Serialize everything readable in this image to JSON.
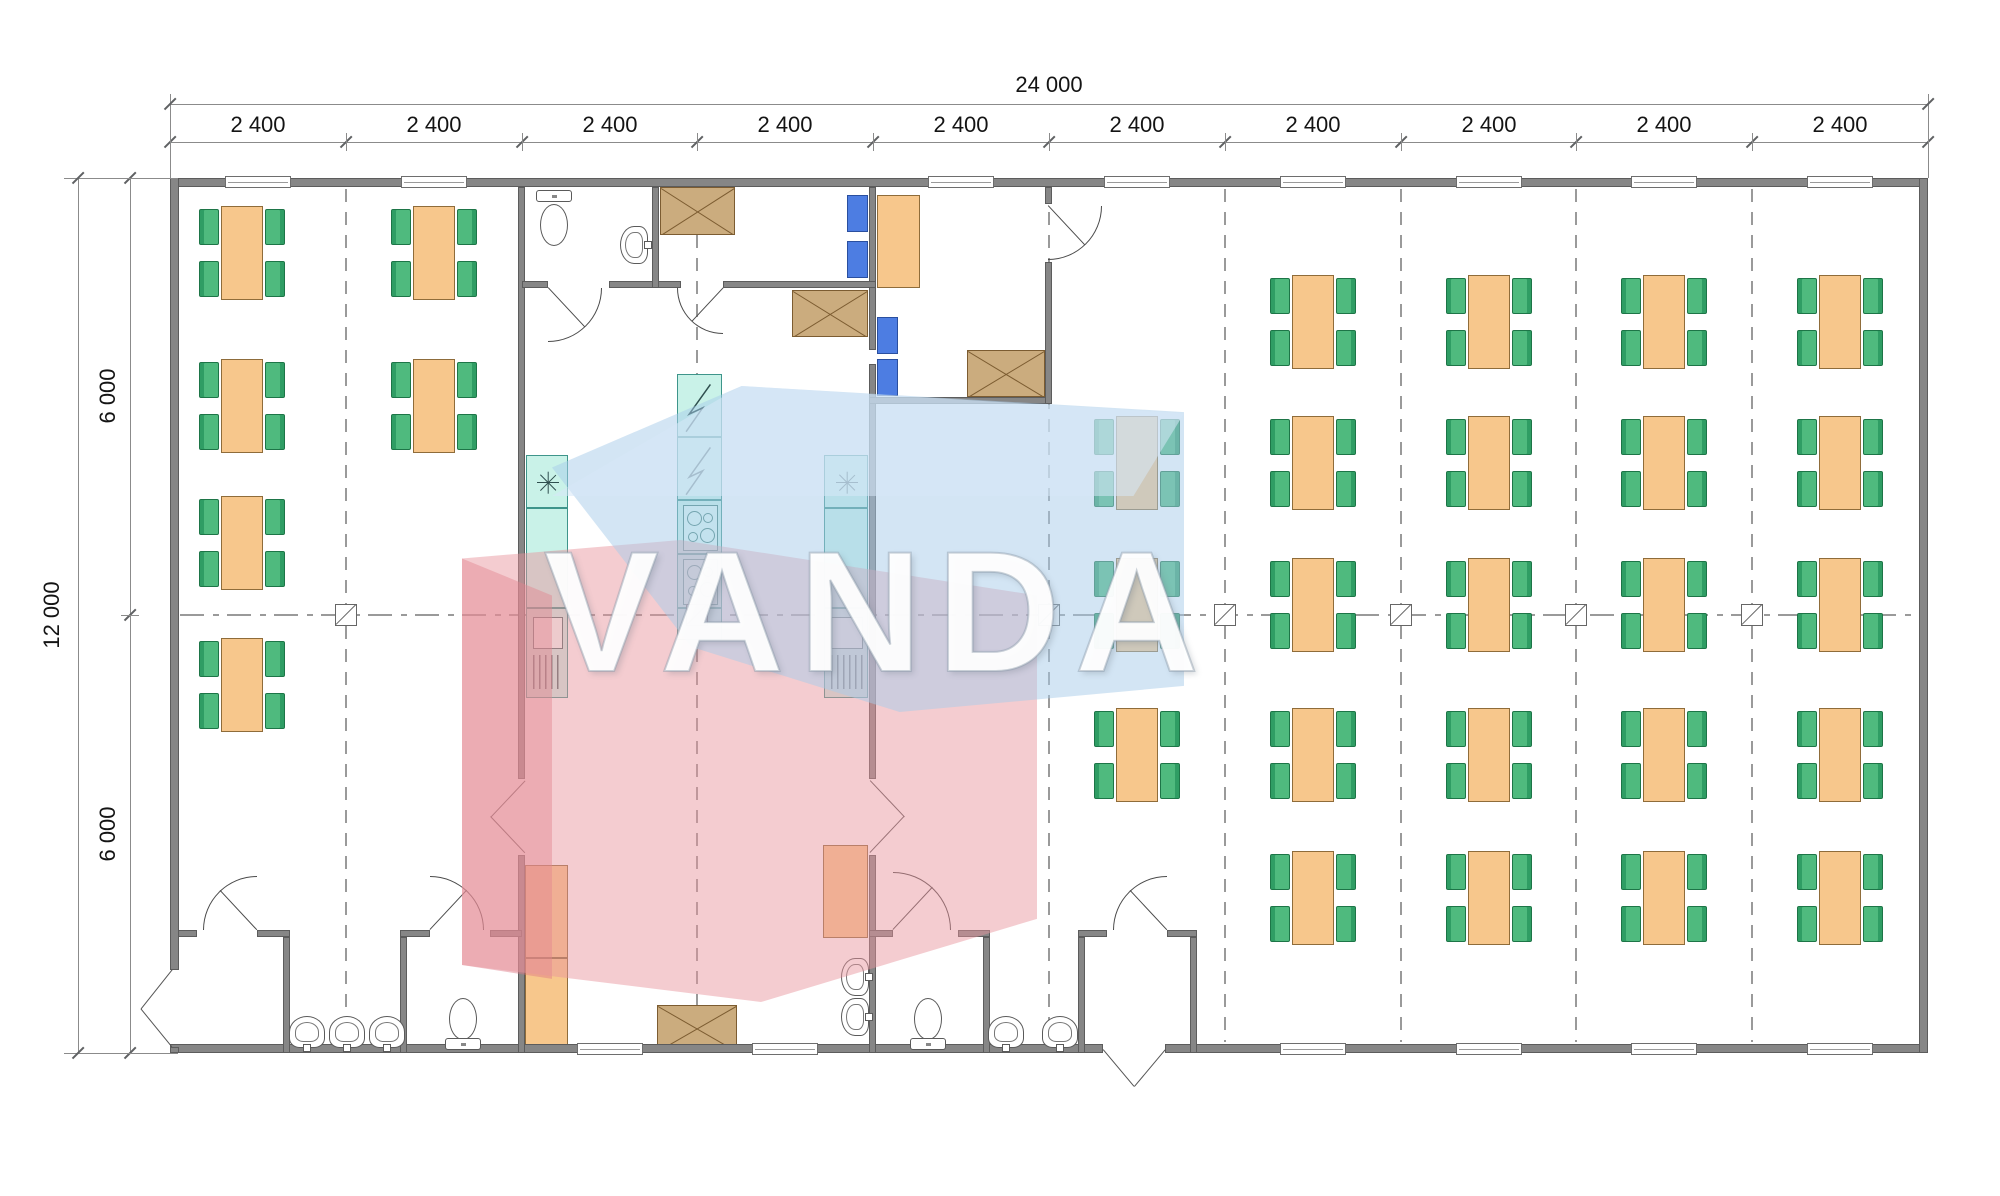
{
  "watermark": {
    "text": "VANDA",
    "blue": "rgba(168,203,233,0.5)",
    "blue_light": "rgba(215,232,248,0.55)",
    "red": "rgba(232,148,156,0.48)",
    "red_dark": "rgba(222,120,132,0.45)"
  },
  "dimensions": {
    "top_total": "24 000",
    "top_modules": [
      "2 400",
      "2 400",
      "2 400",
      "2 400",
      "2 400",
      "2 400",
      "2 400",
      "2 400",
      "2 400",
      "2 400"
    ],
    "left_total": "12 000",
    "left_halves": [
      "6 000",
      "6 000"
    ]
  },
  "plan": {
    "canvas": {
      "w": 2000,
      "h": 1196
    },
    "building": {
      "x": 170,
      "y": 178,
      "w": 1758,
      "h": 875
    },
    "module_x": [
      170,
      346,
      522,
      697,
      873,
      1049,
      1225,
      1401,
      1576,
      1752,
      1928
    ],
    "module_centers_x": [
      258,
      434,
      610,
      785,
      961,
      1137,
      1313,
      1489,
      1664,
      1840
    ],
    "dash_x": [
      346,
      697,
      1049,
      1225,
      1401,
      1576,
      1752
    ],
    "center_y": 615,
    "colors": {
      "wall": "#868686",
      "table": "#f7c78c",
      "chair": "#4fba7e",
      "teal": "#c9f2e8",
      "blue": "#4d7de2",
      "xbox": "#cbac7e"
    },
    "walls": [
      [
        170,
        178,
        1758,
        9
      ],
      [
        170,
        1044,
        933,
        9
      ],
      [
        1165,
        1044,
        763,
        9
      ],
      [
        170,
        178,
        9,
        792
      ],
      [
        170,
        1047,
        9,
        6
      ],
      [
        1919,
        178,
        9,
        875
      ],
      [
        518,
        187,
        7,
        592
      ],
      [
        518,
        855,
        7,
        198
      ],
      [
        869,
        187,
        7,
        163
      ],
      [
        869,
        364,
        7,
        415
      ],
      [
        869,
        855,
        7,
        198
      ],
      [
        522,
        281,
        26,
        7
      ],
      [
        609,
        281,
        72,
        7
      ],
      [
        723,
        281,
        153,
        7
      ],
      [
        652,
        187,
        7,
        101
      ],
      [
        869,
        397,
        183,
        7
      ],
      [
        1045,
        187,
        7,
        17
      ],
      [
        1045,
        262,
        7,
        142
      ],
      [
        178,
        930,
        19,
        7
      ],
      [
        257,
        930,
        33,
        7
      ],
      [
        283,
        937,
        7,
        116
      ],
      [
        400,
        930,
        30,
        7
      ],
      [
        490,
        930,
        32,
        7
      ],
      [
        400,
        937,
        7,
        116
      ],
      [
        869,
        930,
        24,
        7
      ],
      [
        958,
        930,
        32,
        7
      ],
      [
        983,
        937,
        7,
        116
      ],
      [
        1078,
        930,
        29,
        7
      ],
      [
        1167,
        930,
        30,
        7
      ],
      [
        1078,
        937,
        7,
        116
      ],
      [
        1190,
        937,
        7,
        116
      ]
    ],
    "windows_top": [
      258,
      434,
      961,
      1137,
      1313,
      1489,
      1664,
      1840
    ],
    "windows_bottom": [
      610,
      785,
      1313,
      1489,
      1664,
      1840
    ],
    "tables": [
      [
        242,
        253
      ],
      [
        242,
        406
      ],
      [
        242,
        543
      ],
      [
        242,
        685
      ],
      [
        434,
        253
      ],
      [
        434,
        406
      ],
      [
        1137,
        463
      ],
      [
        1137,
        605
      ],
      [
        1137,
        755
      ],
      [
        1313,
        322
      ],
      [
        1313,
        463
      ],
      [
        1313,
        605
      ],
      [
        1313,
        755
      ],
      [
        1313,
        898
      ],
      [
        1489,
        322
      ],
      [
        1489,
        463
      ],
      [
        1489,
        605
      ],
      [
        1489,
        755
      ],
      [
        1489,
        898
      ],
      [
        1664,
        322
      ],
      [
        1664,
        463
      ],
      [
        1664,
        605
      ],
      [
        1664,
        755
      ],
      [
        1664,
        898
      ],
      [
        1840,
        322
      ],
      [
        1840,
        463
      ],
      [
        1840,
        605
      ],
      [
        1840,
        755
      ],
      [
        1840,
        898
      ]
    ],
    "blue_chairs": [
      [
        847,
        195
      ],
      [
        847,
        241
      ],
      [
        877,
        317
      ],
      [
        877,
        359
      ]
    ],
    "orange_boxes": [
      [
        877,
        195,
        43,
        93
      ],
      [
        823,
        845,
        45,
        93
      ],
      [
        525,
        865,
        43,
        93
      ],
      [
        525,
        958,
        43,
        93
      ]
    ],
    "x_boxes": [
      [
        660,
        187,
        75,
        48
      ],
      [
        792,
        290,
        76,
        47
      ],
      [
        967,
        350,
        78,
        47
      ],
      [
        657,
        1005,
        80,
        46
      ]
    ],
    "teal_units": [
      {
        "x": 526,
        "y": 455,
        "w": 42,
        "sections": [
          [
            "star",
            53
          ],
          [
            "plain",
            100
          ],
          [
            "fridge",
            90
          ]
        ]
      },
      {
        "x": 824,
        "y": 455,
        "w": 44,
        "sections": [
          [
            "star",
            53
          ],
          [
            "plain",
            100
          ],
          [
            "fridge",
            90
          ]
        ]
      },
      {
        "x": 677,
        "y": 374,
        "w": 45,
        "sections": [
          [
            "bolt",
            63
          ],
          [
            "bolt",
            63
          ],
          [
            "burners",
            54
          ],
          [
            "burners",
            54
          ],
          [
            "plain",
            32
          ]
        ]
      }
    ],
    "toilets": [
      {
        "x": 536,
        "y": 188,
        "dir": "down"
      },
      {
        "x": 445,
        "y": 998,
        "dir": "up"
      },
      {
        "x": 910,
        "y": 998,
        "dir": "up"
      }
    ],
    "sinks": [
      {
        "x": 620,
        "y": 226,
        "dir": "right"
      },
      {
        "x": 289,
        "y": 1016,
        "dir": "up"
      },
      {
        "x": 329,
        "y": 1016,
        "dir": "up"
      },
      {
        "x": 369,
        "y": 1016,
        "dir": "up"
      },
      {
        "x": 988,
        "y": 1016,
        "dir": "up"
      },
      {
        "x": 1042,
        "y": 1016,
        "dir": "up"
      },
      {
        "x": 841,
        "y": 958,
        "dir": "right"
      },
      {
        "x": 841,
        "y": 998,
        "dir": "right"
      }
    ],
    "arc_doors": [
      {
        "hx": 548,
        "hy": 288,
        "r": 54,
        "q": "se"
      },
      {
        "hx": 723,
        "hy": 288,
        "r": 46,
        "q": "sw"
      },
      {
        "hx": 1048,
        "hy": 206,
        "r": 54,
        "q": "se"
      },
      {
        "hx": 257,
        "hy": 930,
        "r": 54,
        "q": "nw"
      },
      {
        "hx": 430,
        "hy": 930,
        "r": 54,
        "q": "ne"
      },
      {
        "hx": 893,
        "hy": 930,
        "r": 58,
        "q": "ne"
      },
      {
        "hx": 1167,
        "hy": 930,
        "r": 54,
        "q": "nw"
      }
    ],
    "v_doors": [
      [
        525,
        781,
        491,
        817
      ],
      [
        525,
        853,
        491,
        817
      ],
      [
        870,
        781,
        904,
        817
      ],
      [
        870,
        853,
        904,
        817
      ],
      [
        172,
        970,
        141,
        1009
      ],
      [
        172,
        1047,
        141,
        1009
      ],
      [
        1103,
        1050,
        1134,
        1087
      ],
      [
        1165,
        1050,
        1134,
        1087
      ]
    ],
    "dims": {
      "top_total_y": 104,
      "top_seg_y": 142,
      "left_total_x": 78,
      "left_seg_x": 130,
      "left_seg_ticks_y": [
        178,
        615,
        1053
      ]
    }
  }
}
